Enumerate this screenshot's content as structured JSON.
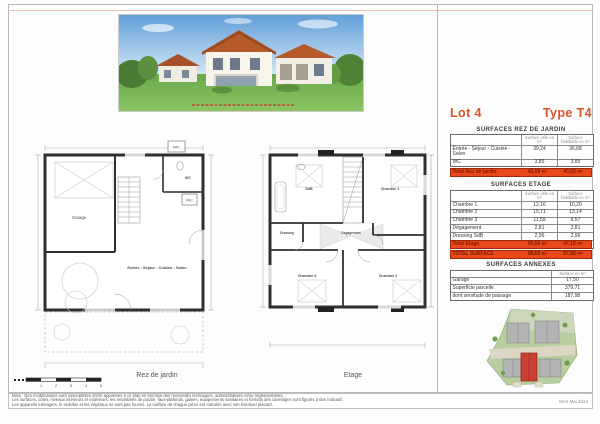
{
  "header": {
    "lot": "Lot 4",
    "type": "Type T4"
  },
  "surfaces": {
    "col_utile": "Surface utile en m²",
    "col_habitable": "Surface habitable en m²",
    "rdj": {
      "title": "SURFACES REZ DE JARDIN",
      "rows": [
        {
          "label": "Entrée - Séjour - Cuisine - Salon",
          "utile": "39,24",
          "habitable": "36,68"
        },
        {
          "label": "WC",
          "utile": "3,85",
          "habitable": "3,85"
        }
      ],
      "total": {
        "label": "Total Rez de jardin",
        "utile": "43,09 m²",
        "habitable": "40,53 m²"
      }
    },
    "etage": {
      "title": "SURFACES ETAGE",
      "rows": [
        {
          "label": "Chambre 1",
          "utile": "12,16",
          "habitable": "10,20"
        },
        {
          "label": "Chambre 2",
          "utile": "15,71",
          "habitable": "13,14"
        },
        {
          "label": "Chambre 3",
          "utile": "11,59",
          "habitable": "9,57"
        },
        {
          "label": "Dégagement",
          "utile": "2,81",
          "habitable": "2,81"
        },
        {
          "label": "Dressing SdB",
          "utile": "2,96",
          "habitable": "2,96"
        },
        {
          "label": "",
          "utile": "10,37",
          "habitable": "8,47"
        }
      ],
      "total": {
        "label": "Total Etage",
        "utile": "55,60 m²",
        "habitable": "47,15 m²"
      },
      "grand": {
        "label": "TOTAL SURFACE",
        "utile": "98,69 m²",
        "habitable": "87,68 m²"
      }
    },
    "annexes": {
      "title": "SURFACES ANNEXES",
      "col": "Surface en m²",
      "rows": [
        {
          "label": "Garage",
          "value": "17,50"
        },
        {
          "label": "Superficie parcelle",
          "value": "379,71"
        },
        {
          "label": "dont servitude de passage",
          "value": "187,98"
        }
      ]
    }
  },
  "plans": {
    "rdj": {
      "caption": "Rez de jardin",
      "garage": "Garage",
      "wc": "WC",
      "pac": "PAC",
      "pac2": "PAC",
      "main_room": "Entrée - Séjour - Cuisine - Salon"
    },
    "etage": {
      "caption": "Etage",
      "sdb": "SdB",
      "ch1": "Chambre 1",
      "ch2": "Chambre 2",
      "ch3": "Chambre 3",
      "dressing": "Dressing",
      "degagement": "Dégagement"
    }
  },
  "scalebar": {
    "labels": [
      "1",
      "2",
      "3",
      "4",
      "5"
    ]
  },
  "footer": {
    "note1": "Nota : Des modifications sont susceptibles d'être apportées à ce plan en fonction des nécessités techniques, administratives et/ou réglementaires.",
    "note2": "Les surfaces, côtes, niveaux intérieurs et extérieurs, les retombées de poutre, faux-plafonds, gaines, équipements sanitaires et formats des carrelages sont figurés à titre indicatif.",
    "note3": "Les appareils ménagers, le mobilier et les végétaux ne sont pas fournis. La surface de chaque pièce est calculée avec son éventuel placard.",
    "maj": "MAJ Mai 2024"
  },
  "colors": {
    "accent": "#dd5226",
    "total_row_bg": "#e8481c"
  }
}
